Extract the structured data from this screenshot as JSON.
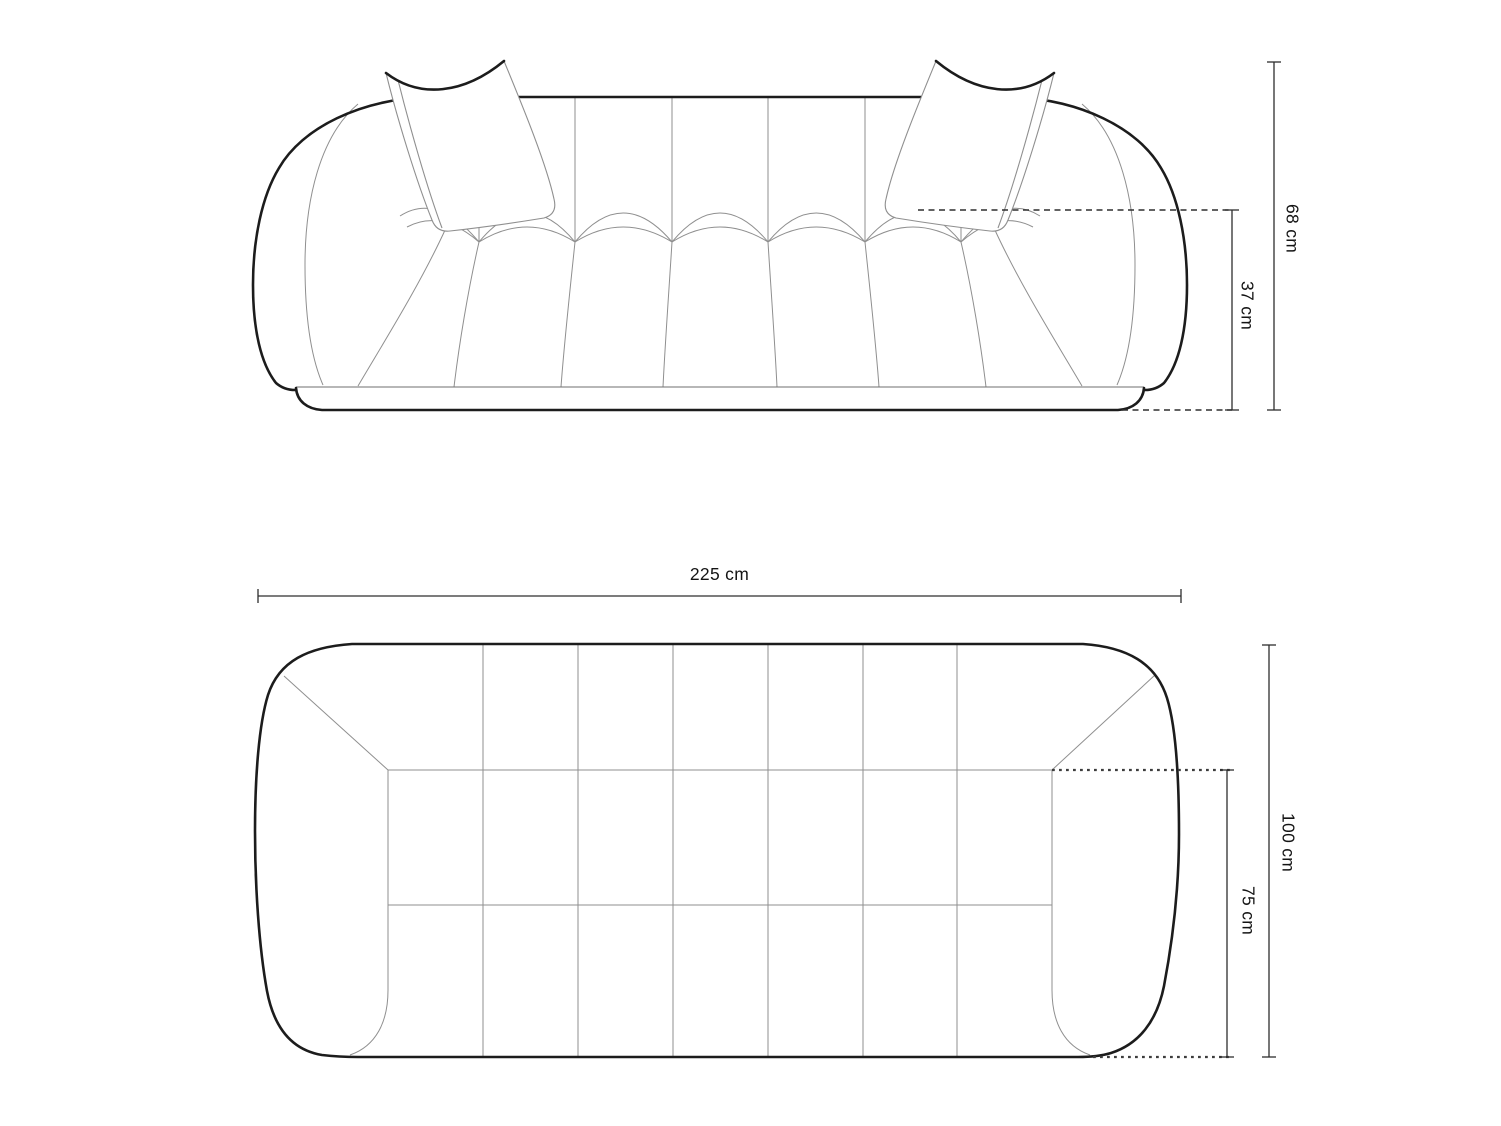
{
  "document": {
    "background": "#ffffff",
    "description": "Technical line drawing of a rounded tufted sofa with two loose back cushions: front elevation (top) and top plan view (bottom) with dimension annotations"
  },
  "front_view": {
    "name": "front-elevation",
    "dimensions": {
      "total_height": {
        "label": "68 cm",
        "orientation": "vertical"
      },
      "seat_height": {
        "label": "37 cm",
        "orientation": "vertical"
      }
    }
  },
  "top_view": {
    "name": "top-plan",
    "dimensions": {
      "total_width": {
        "label": "225 cm",
        "orientation": "horizontal"
      },
      "total_depth": {
        "label": "100 cm",
        "orientation": "vertical"
      },
      "seat_depth": {
        "label": "75 cm",
        "orientation": "vertical"
      }
    }
  },
  "style": {
    "outline_color": "#1c1c1c",
    "seam_color": "#8f8f8f",
    "dimension_color": "#2e2e2e",
    "label_color": "#141414",
    "background": "#ffffff"
  }
}
